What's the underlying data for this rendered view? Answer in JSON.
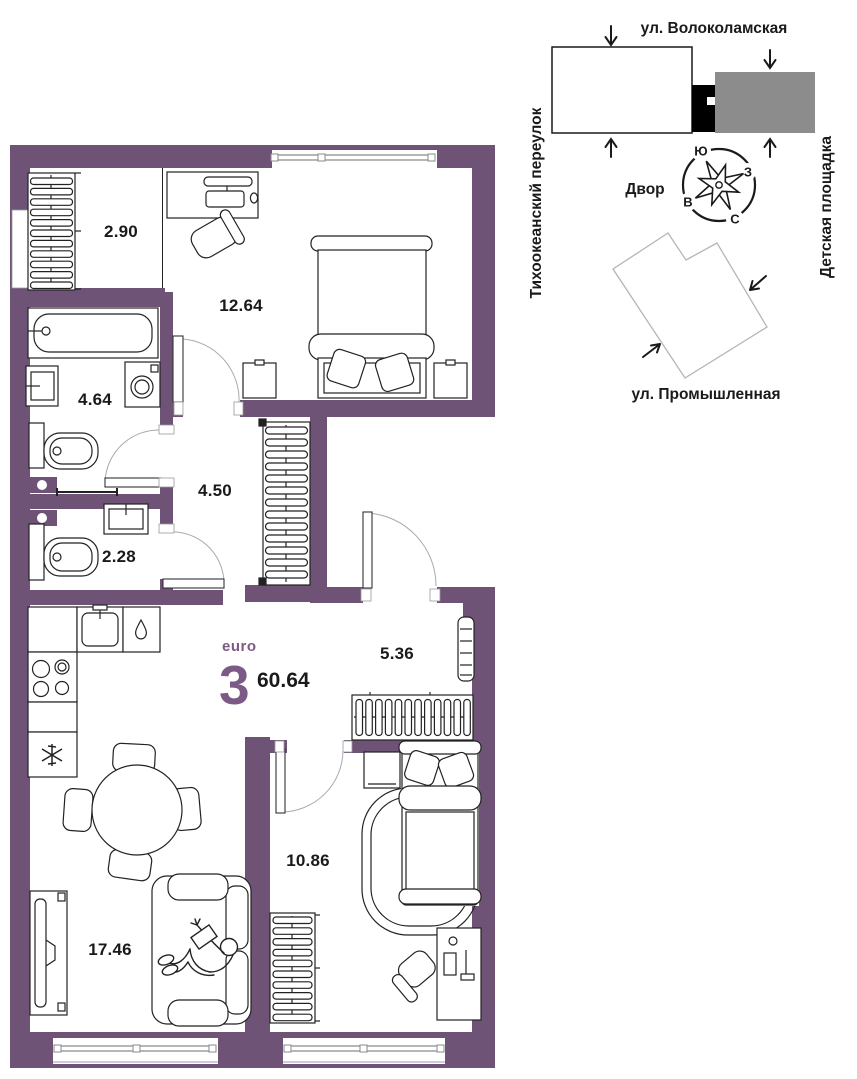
{
  "plan": {
    "unit_type_label": "euro",
    "unit_rooms": "3",
    "total_area": "60.64",
    "room_areas": {
      "closet": "2.90",
      "bedroom1": "12.64",
      "bathroom": "4.64",
      "hallway": "4.50",
      "wc": "2.28",
      "entry": "5.36",
      "bedroom2": "10.86",
      "living": "17.46"
    }
  },
  "site_map": {
    "street_top": "ул. Волоколамская",
    "street_left": "Тихоокеанский переулок",
    "street_bottom": "ул. Промышленная",
    "area_right": "Детская площадка",
    "courtyard": "Двор",
    "compass": {
      "north": "С",
      "south": "Ю",
      "east": "В",
      "west": "З"
    }
  },
  "colors": {
    "wall": "#6E5377",
    "accent": "#7B5A86",
    "building_gray": "#8C8C8C",
    "building_black": "#000000",
    "line": "#1a1a1a"
  }
}
